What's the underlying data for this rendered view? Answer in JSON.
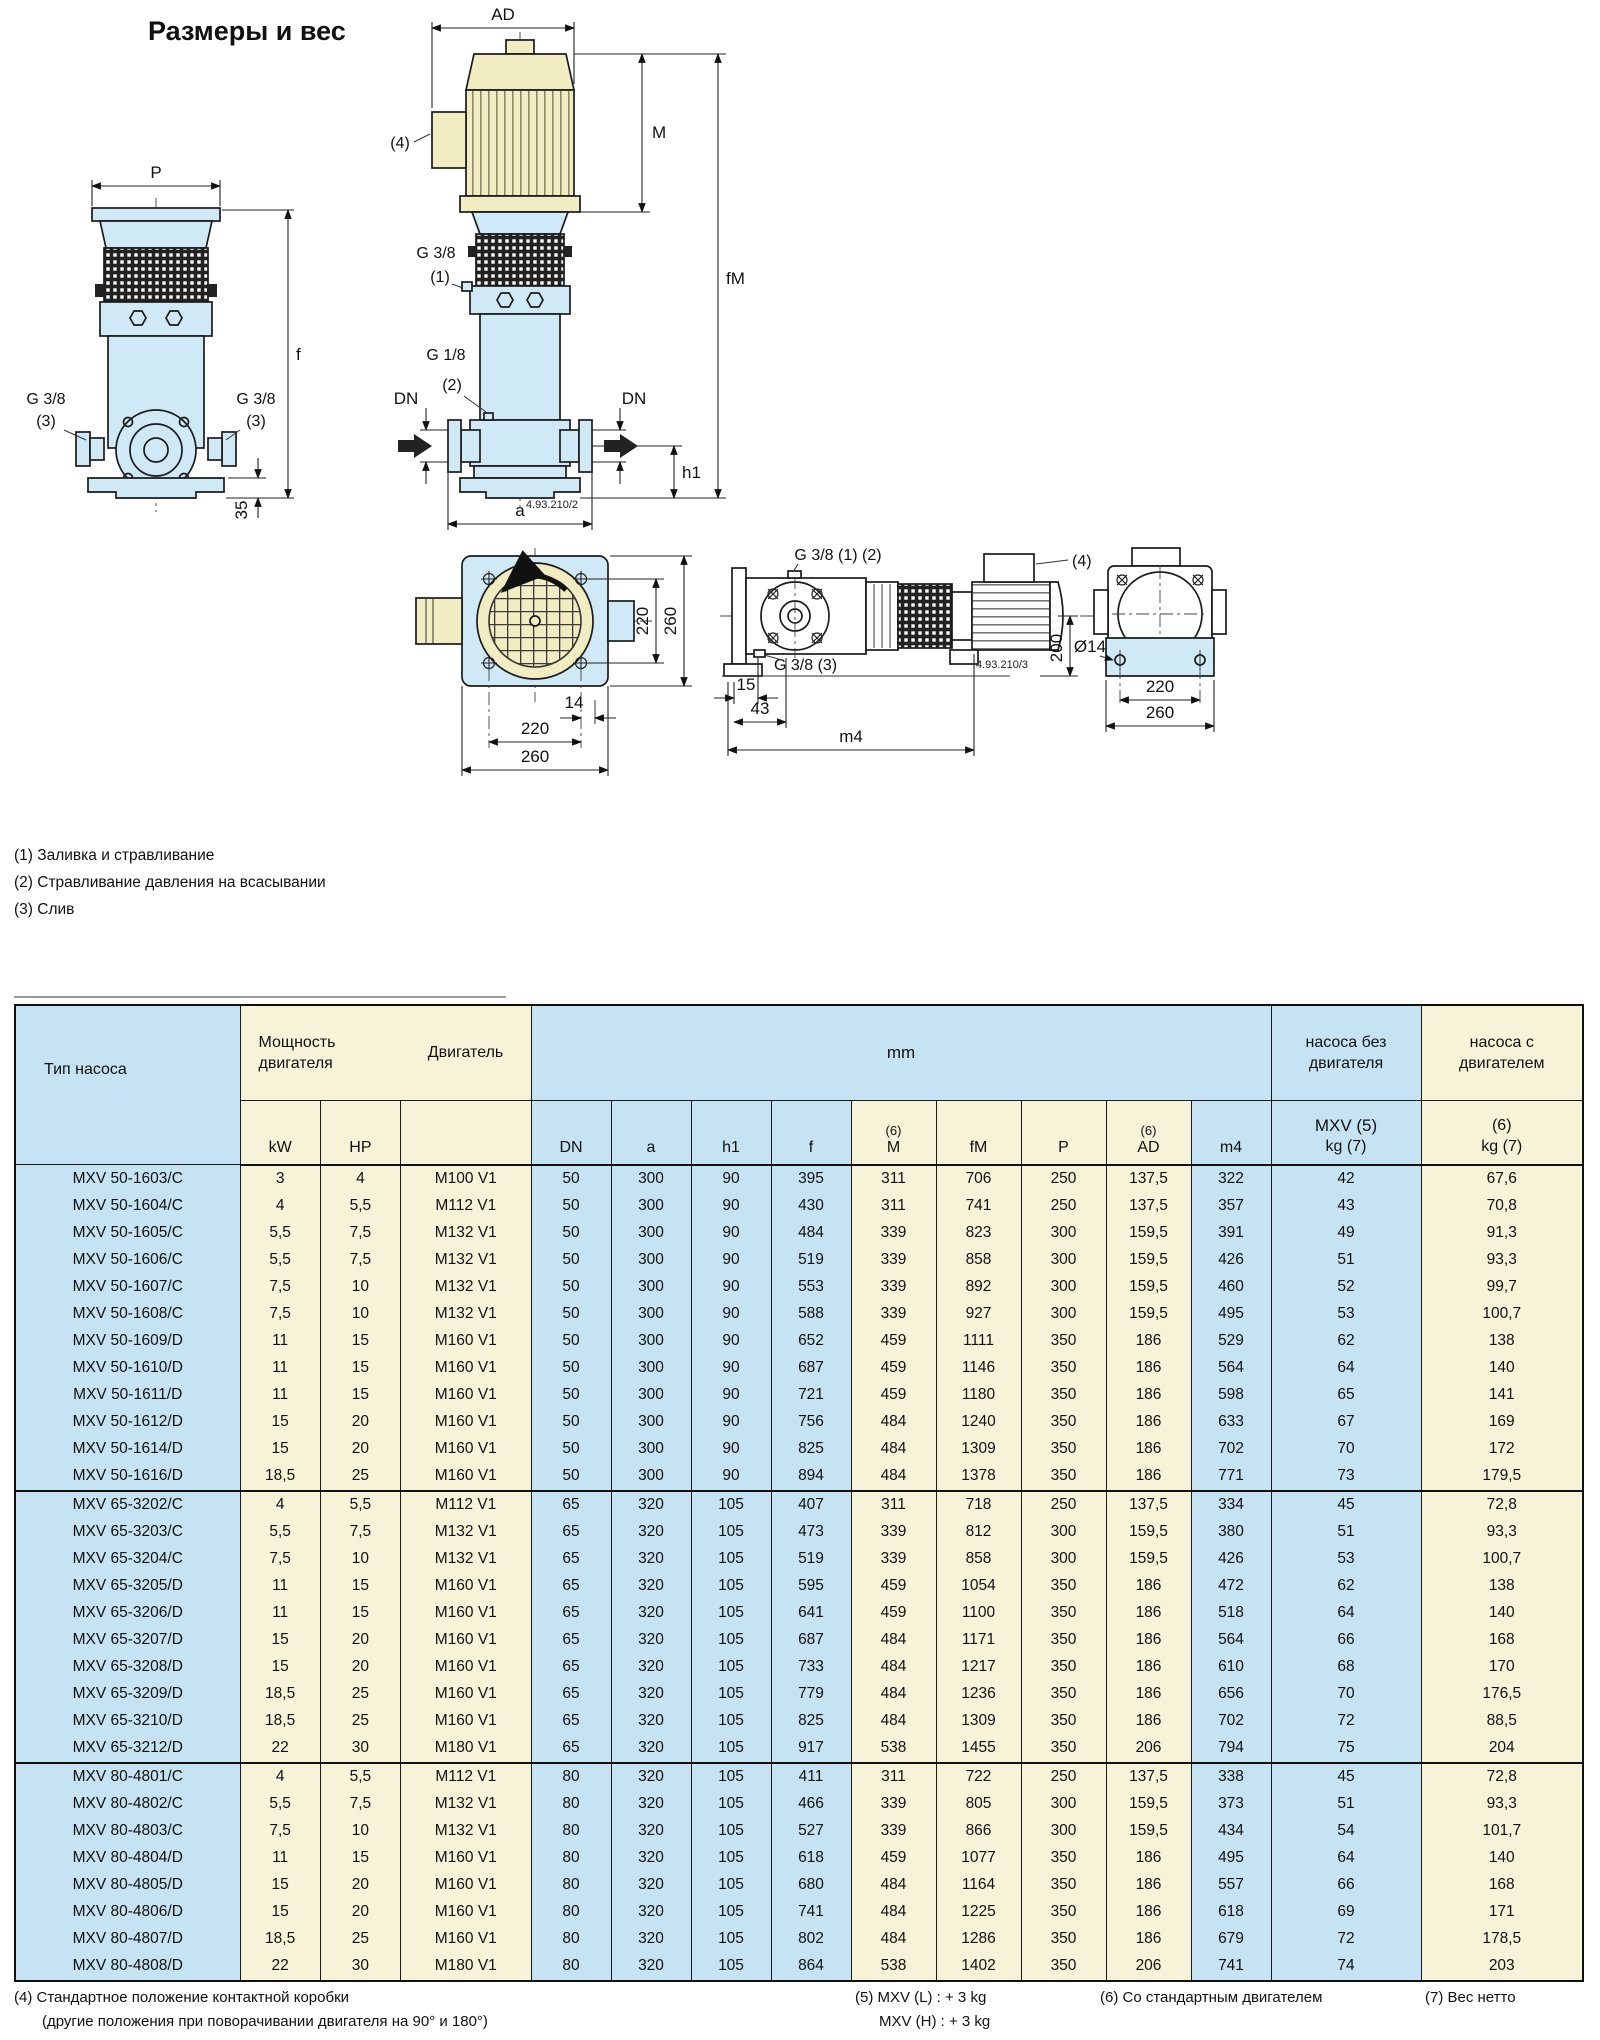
{
  "page": {
    "title": "Размеры и вес"
  },
  "drawings": {
    "labels": {
      "p": "P",
      "f": "f",
      "g38": "G 3/8",
      "n1": "(1)",
      "n2": "(2)",
      "n3": "(3)",
      "n4": "(4)",
      "d35": "35",
      "ad": "AD",
      "m": "M",
      "fm": "fM",
      "g18": "G 1/8",
      "dn": "DN",
      "h1": "h1",
      "a": "a",
      "code2": "4.93.210/2",
      "code3": "4.93.210/3",
      "d220": "220",
      "d260": "260",
      "d14": "14",
      "g38_12": "G 3/8 (1) (2)",
      "g38_3": "G 3/8 (3)",
      "d200": "200",
      "dia14": "Ø14",
      "d15": "15",
      "d43": "43",
      "m4": "m4"
    },
    "notes": [
      "(1) Заливка и стравливание",
      "(2) Стравливание давления на всасывании",
      "(3) Слив"
    ]
  },
  "table": {
    "header": {
      "pump_type": "Тип насоса",
      "power": "Мощность двигателя",
      "motor": "Двигатель",
      "mm": "mm",
      "kw": "kW",
      "hp": "HP",
      "cols": [
        "DN",
        "a",
        "h1",
        "f",
        "M",
        "fM",
        "P",
        "AD",
        "m4"
      ],
      "sup6": "(6)",
      "without_motor_l1": "насоса без",
      "without_motor_l2": "двигателя",
      "with_motor_l1": "насоса с",
      "with_motor_l2": "двигателем",
      "mxv_kg_l1": "MXV (5)",
      "mxv_kg_l2": "kg (7)",
      "with_kg_l1": "(6)",
      "with_kg_l2": "kg (7)"
    },
    "groups": [
      {
        "rows": [
          [
            "MXV 50-1603/C",
            "3",
            "4",
            "M100 V1",
            "50",
            "300",
            "90",
            "395",
            "311",
            "706",
            "250",
            "137,5",
            "322",
            "42",
            "67,6"
          ],
          [
            "MXV 50-1604/C",
            "4",
            "5,5",
            "M112 V1",
            "50",
            "300",
            "90",
            "430",
            "311",
            "741",
            "250",
            "137,5",
            "357",
            "43",
            "70,8"
          ],
          [
            "MXV 50-1605/C",
            "5,5",
            "7,5",
            "M132 V1",
            "50",
            "300",
            "90",
            "484",
            "339",
            "823",
            "300",
            "159,5",
            "391",
            "49",
            "91,3"
          ],
          [
            "MXV 50-1606/C",
            "5,5",
            "7,5",
            "M132 V1",
            "50",
            "300",
            "90",
            "519",
            "339",
            "858",
            "300",
            "159,5",
            "426",
            "51",
            "93,3"
          ],
          [
            "MXV 50-1607/C",
            "7,5",
            "10",
            "M132 V1",
            "50",
            "300",
            "90",
            "553",
            "339",
            "892",
            "300",
            "159,5",
            "460",
            "52",
            "99,7"
          ],
          [
            "MXV 50-1608/C",
            "7,5",
            "10",
            "M132 V1",
            "50",
            "300",
            "90",
            "588",
            "339",
            "927",
            "300",
            "159,5",
            "495",
            "53",
            "100,7"
          ],
          [
            "MXV 50-1609/D",
            "11",
            "15",
            "M160 V1",
            "50",
            "300",
            "90",
            "652",
            "459",
            "1111",
            "350",
            "186",
            "529",
            "62",
            "138"
          ],
          [
            "MXV 50-1610/D",
            "11",
            "15",
            "M160 V1",
            "50",
            "300",
            "90",
            "687",
            "459",
            "1146",
            "350",
            "186",
            "564",
            "64",
            "140"
          ],
          [
            "MXV 50-1611/D",
            "11",
            "15",
            "M160 V1",
            "50",
            "300",
            "90",
            "721",
            "459",
            "1180",
            "350",
            "186",
            "598",
            "65",
            "141"
          ],
          [
            "MXV 50-1612/D",
            "15",
            "20",
            "M160 V1",
            "50",
            "300",
            "90",
            "756",
            "484",
            "1240",
            "350",
            "186",
            "633",
            "67",
            "169"
          ],
          [
            "MXV 50-1614/D",
            "15",
            "20",
            "M160 V1",
            "50",
            "300",
            "90",
            "825",
            "484",
            "1309",
            "350",
            "186",
            "702",
            "70",
            "172"
          ],
          [
            "MXV 50-1616/D",
            "18,5",
            "25",
            "M160 V1",
            "50",
            "300",
            "90",
            "894",
            "484",
            "1378",
            "350",
            "186",
            "771",
            "73",
            "179,5"
          ]
        ]
      },
      {
        "rows": [
          [
            "MXV 65-3202/C",
            "4",
            "5,5",
            "M112 V1",
            "65",
            "320",
            "105",
            "407",
            "311",
            "718",
            "250",
            "137,5",
            "334",
            "45",
            "72,8"
          ],
          [
            "MXV 65-3203/C",
            "5,5",
            "7,5",
            "M132 V1",
            "65",
            "320",
            "105",
            "473",
            "339",
            "812",
            "300",
            "159,5",
            "380",
            "51",
            "93,3"
          ],
          [
            "MXV 65-3204/C",
            "7,5",
            "10",
            "M132 V1",
            "65",
            "320",
            "105",
            "519",
            "339",
            "858",
            "300",
            "159,5",
            "426",
            "53",
            "100,7"
          ],
          [
            "MXV 65-3205/D",
            "11",
            "15",
            "M160 V1",
            "65",
            "320",
            "105",
            "595",
            "459",
            "1054",
            "350",
            "186",
            "472",
            "62",
            "138"
          ],
          [
            "MXV 65-3206/D",
            "11",
            "15",
            "M160 V1",
            "65",
            "320",
            "105",
            "641",
            "459",
            "1100",
            "350",
            "186",
            "518",
            "64",
            "140"
          ],
          [
            "MXV 65-3207/D",
            "15",
            "20",
            "M160 V1",
            "65",
            "320",
            "105",
            "687",
            "484",
            "1171",
            "350",
            "186",
            "564",
            "66",
            "168"
          ],
          [
            "MXV 65-3208/D",
            "15",
            "20",
            "M160 V1",
            "65",
            "320",
            "105",
            "733",
            "484",
            "1217",
            "350",
            "186",
            "610",
            "68",
            "170"
          ],
          [
            "MXV 65-3209/D",
            "18,5",
            "25",
            "M160 V1",
            "65",
            "320",
            "105",
            "779",
            "484",
            "1236",
            "350",
            "186",
            "656",
            "70",
            "176,5"
          ],
          [
            "MXV 65-3210/D",
            "18,5",
            "25",
            "M160 V1",
            "65",
            "320",
            "105",
            "825",
            "484",
            "1309",
            "350",
            "186",
            "702",
            "72",
            "88,5"
          ],
          [
            "MXV 65-3212/D",
            "22",
            "30",
            "M180 V1",
            "65",
            "320",
            "105",
            "917",
            "538",
            "1455",
            "350",
            "206",
            "794",
            "75",
            "204"
          ]
        ]
      },
      {
        "rows": [
          [
            "MXV 80-4801/C",
            "4",
            "5,5",
            "M112 V1",
            "80",
            "320",
            "105",
            "411",
            "311",
            "722",
            "250",
            "137,5",
            "338",
            "45",
            "72,8"
          ],
          [
            "MXV 80-4802/C",
            "5,5",
            "7,5",
            "M132 V1",
            "80",
            "320",
            "105",
            "466",
            "339",
            "805",
            "300",
            "159,5",
            "373",
            "51",
            "93,3"
          ],
          [
            "MXV 80-4803/C",
            "7,5",
            "10",
            "M132 V1",
            "80",
            "320",
            "105",
            "527",
            "339",
            "866",
            "300",
            "159,5",
            "434",
            "54",
            "101,7"
          ],
          [
            "MXV 80-4804/D",
            "11",
            "15",
            "M160 V1",
            "80",
            "320",
            "105",
            "618",
            "459",
            "1077",
            "350",
            "186",
            "495",
            "64",
            "140"
          ],
          [
            "MXV 80-4805/D",
            "15",
            "20",
            "M160 V1",
            "80",
            "320",
            "105",
            "680",
            "484",
            "1164",
            "350",
            "186",
            "557",
            "66",
            "168"
          ],
          [
            "MXV 80-4806/D",
            "15",
            "20",
            "M160 V1",
            "80",
            "320",
            "105",
            "741",
            "484",
            "1225",
            "350",
            "186",
            "618",
            "69",
            "171"
          ],
          [
            "MXV 80-4807/D",
            "18,5",
            "25",
            "M160 V1",
            "80",
            "320",
            "105",
            "802",
            "484",
            "1286",
            "350",
            "186",
            "679",
            "72",
            "178,5"
          ],
          [
            "MXV 80-4808/D",
            "22",
            "30",
            "M180 V1",
            "80",
            "320",
            "105",
            "864",
            "538",
            "1402",
            "350",
            "206",
            "741",
            "74",
            "203"
          ]
        ]
      }
    ]
  },
  "footer": {
    "n4_l1": "(4) Стандартное положение контактной коробки",
    "n4_l2": "(другие положения при поворачивании двигателя на 90° и 180°)",
    "n5_l1": "(5) MXV (L) : + 3 kg",
    "n5_l2": "MXV (H) : + 3 kg",
    "n6": "(6) Со стандартным двигателем",
    "n7": "(7) Вес нетто"
  }
}
